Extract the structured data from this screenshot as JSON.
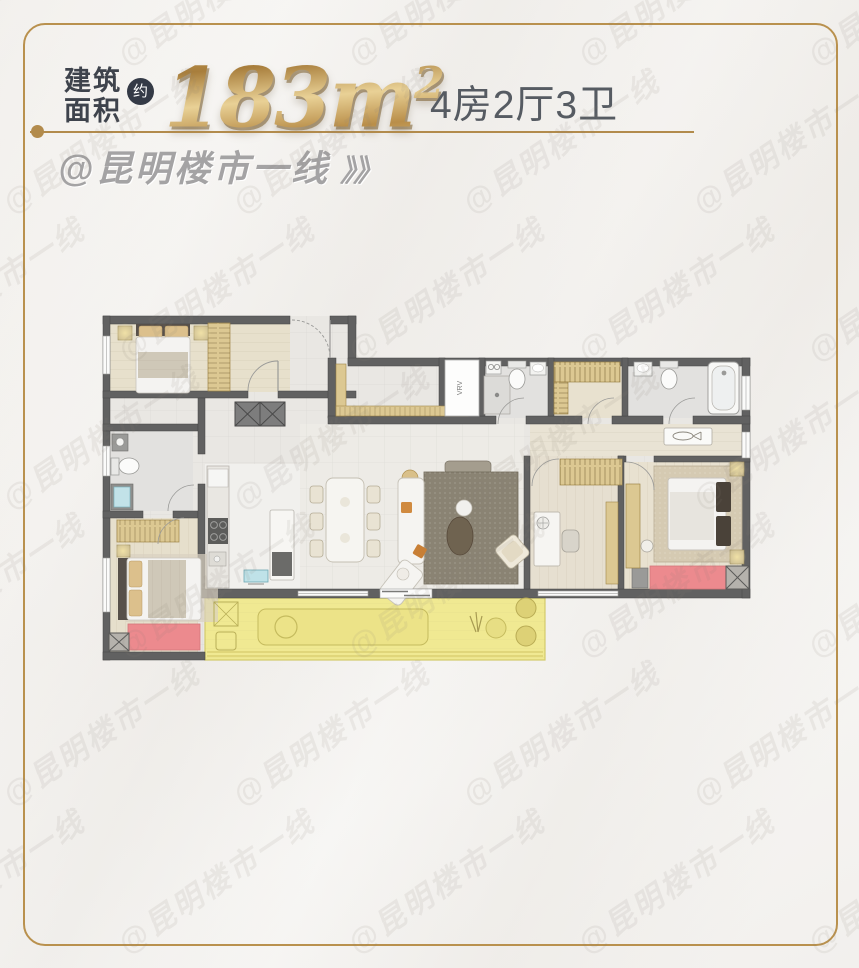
{
  "header": {
    "area_label_line1": "建筑",
    "area_label_line2": "面积",
    "approx_badge": "约",
    "area_value": "183m",
    "area_sup": "2",
    "layout_text": "4房2厅3卫"
  },
  "brand": {
    "handle": "@昆明楼市一线",
    "arrows": "》》"
  },
  "watermark": {
    "text": "@昆明楼市一线"
  },
  "floorplan": {
    "vrv_label": "VRV"
  },
  "colors": {
    "frame_gold": "#b9914e",
    "area_gold_dark": "#a87e3c",
    "area_gold_light": "#e9d196",
    "title_dark": "#3e434c",
    "layout_gray": "#565b62",
    "brand_gray": "#a4a3a4",
    "wall_gray": "#616161",
    "balcony_highlight_yellow": "#f0e992",
    "balcony_highlight_red": "#ec8a8e"
  }
}
